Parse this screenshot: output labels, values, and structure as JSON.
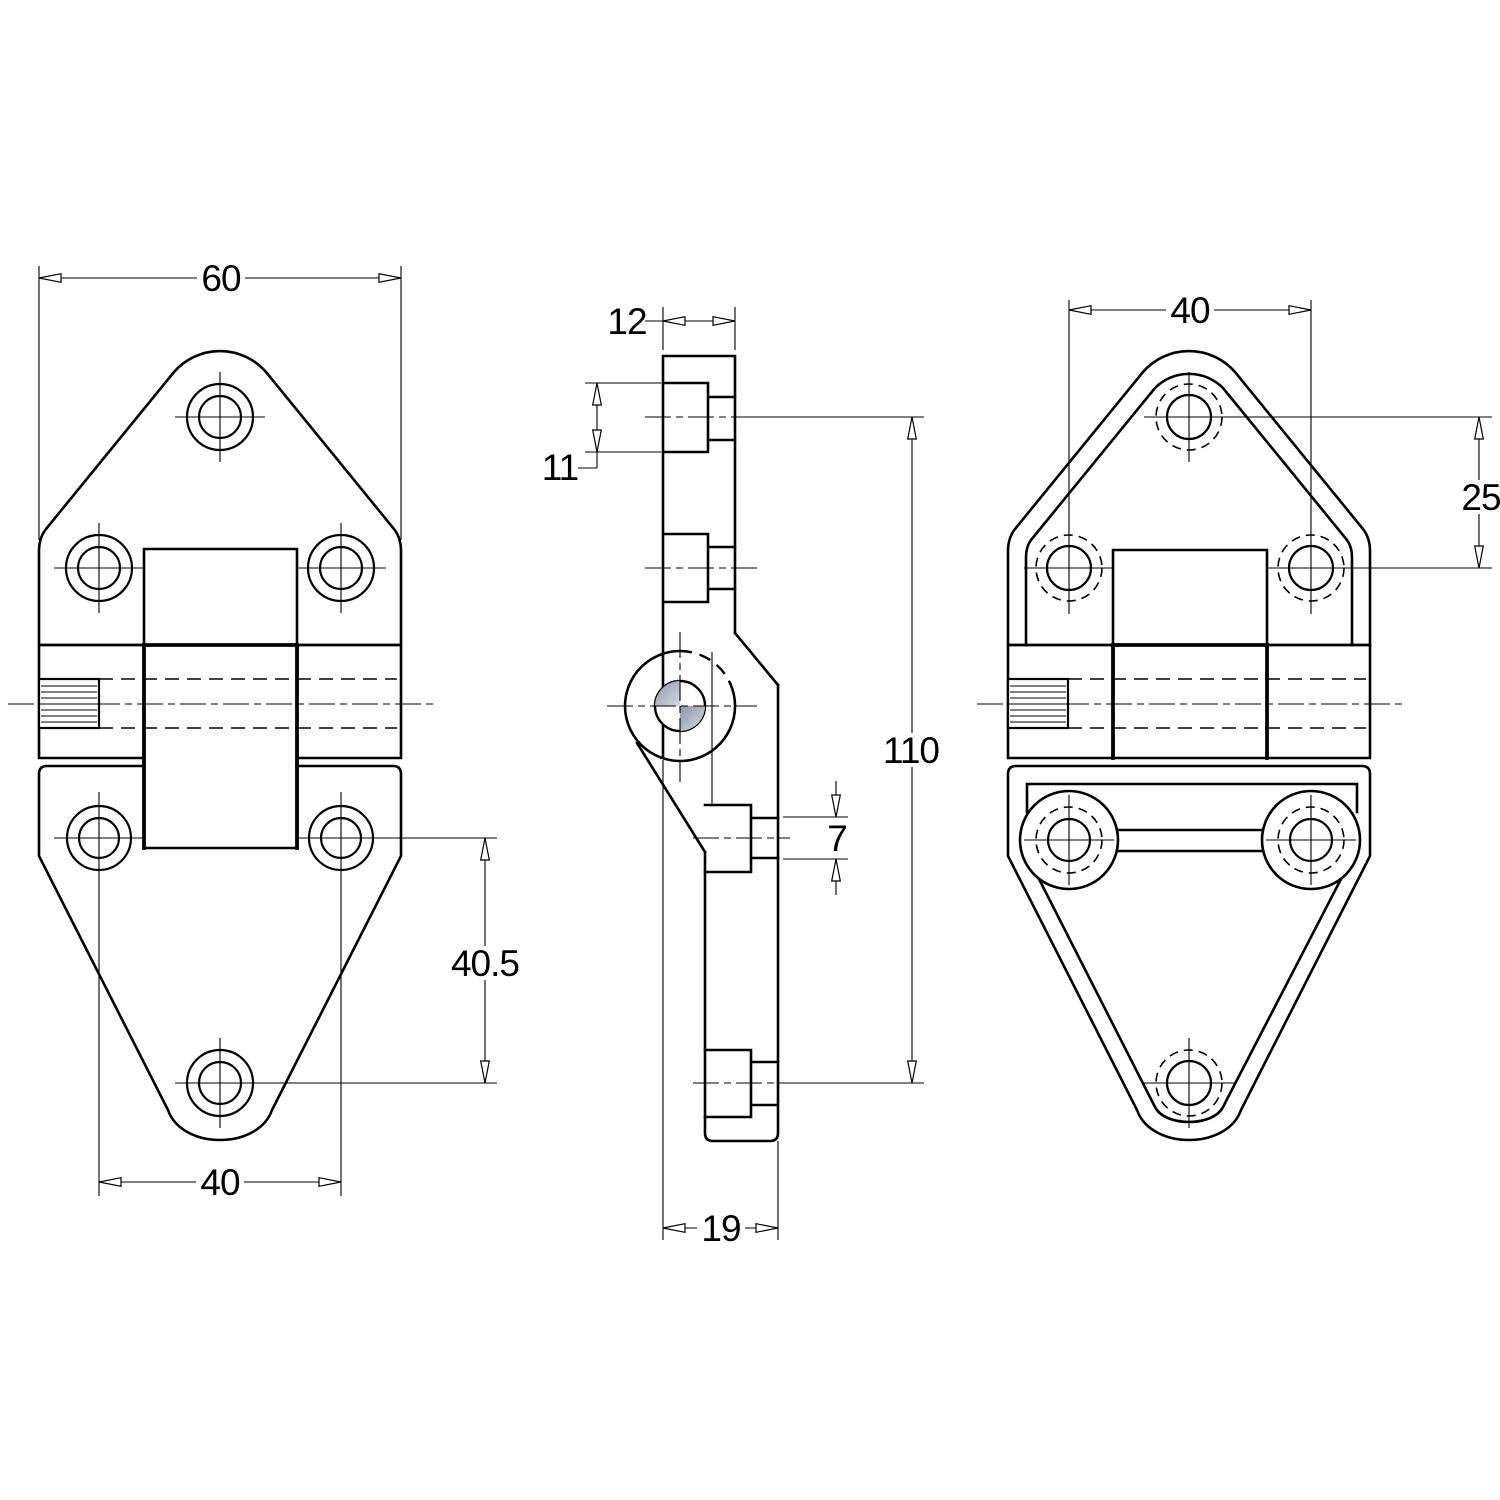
{
  "drawing": {
    "title": "Hinge — three-view dimensioned engineering drawing",
    "views": {
      "front": {
        "name": "front view (left)"
      },
      "side": {
        "name": "side profile view (middle)"
      },
      "back": {
        "name": "back view (right)"
      }
    },
    "dimensions": {
      "front_width": "60",
      "front_lower_hole_spacing": "40",
      "front_lower_hole_offset": "40.5",
      "side_leaf_thickness": "12",
      "side_boss_diameter": "11",
      "side_overall_height": "110",
      "side_hole_diameter": "7",
      "side_overall_depth": "19",
      "back_upper_hole_spacing": "40",
      "back_upper_hole_offset": "25"
    },
    "colors": {
      "line": "#000000",
      "background": "#ffffff",
      "pin_shade_dark": "#8d96a8",
      "pin_shade_light": "#d6dae1"
    }
  }
}
